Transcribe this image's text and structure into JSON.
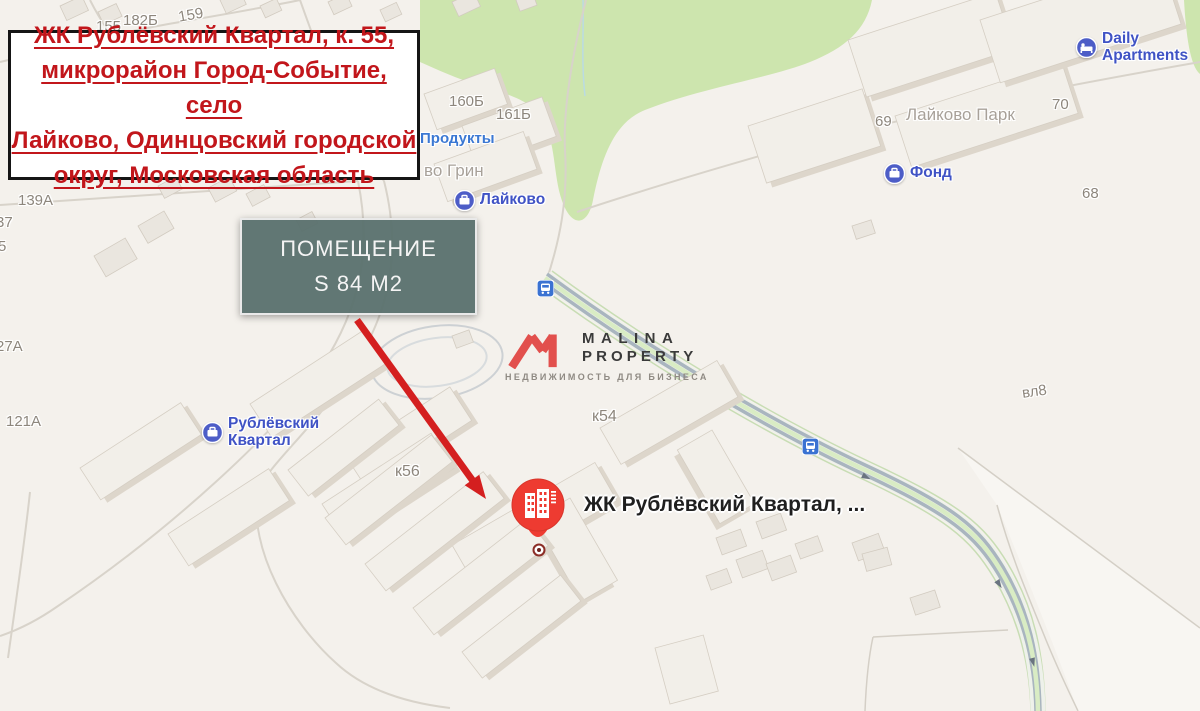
{
  "overlays": {
    "address_box": {
      "lines": [
        "ЖК Рублёвский Квартал, к. 55,",
        "микрорайон Город-Событие, село",
        "Лайково, Одинцовский городской",
        "округ, Московская область"
      ],
      "text_color": "#c2161b",
      "border_color": "#151515"
    },
    "area_box": {
      "title": "ПОМЕЩЕНИЕ",
      "subtitle": "S 84 М2",
      "bg_color": "#5b716e"
    },
    "arrow": {
      "color": "#d41f1f"
    },
    "pin": {
      "label": "ЖК Рублёвский Квартал, ...",
      "color": "#ee3b31",
      "icon": "building-icon"
    },
    "logo": {
      "line1": "MALINA",
      "line2": "PROPERTY",
      "tagline": "НЕДВИЖИМОСТЬ ДЛЯ БИЗНЕСА",
      "mark_color": "#e2504d"
    }
  },
  "map": {
    "background_color": "#f4f1ec",
    "park_color": "#cde5ae",
    "road_lane_color": "#a9b5bf",
    "bike_lane_color": "#d9ecc4",
    "poi_label_color": "#4053c5",
    "pois": [
      {
        "name": "Лайково",
        "icon": "briefcase-icon"
      },
      {
        "name": "Фонд",
        "icon": "briefcase-icon"
      },
      {
        "line1": "Рублёвский",
        "line2": "Квартал",
        "icon": "briefcase-icon"
      },
      {
        "line1": "Daily",
        "line2": "Apartments",
        "icon": "bed-icon"
      },
      {
        "name": "Продукты"
      }
    ],
    "area_names": [
      "во Грин",
      "Лайково Парк"
    ],
    "building_numbers": [
      "182Б",
      "159",
      "155",
      "160Б",
      "161Б",
      "139А",
      "37",
      "5",
      "27А",
      "121А",
      "69",
      "70",
      "68",
      "к56",
      "к54",
      "вл8"
    ],
    "transit_icon": "bus-icon"
  }
}
